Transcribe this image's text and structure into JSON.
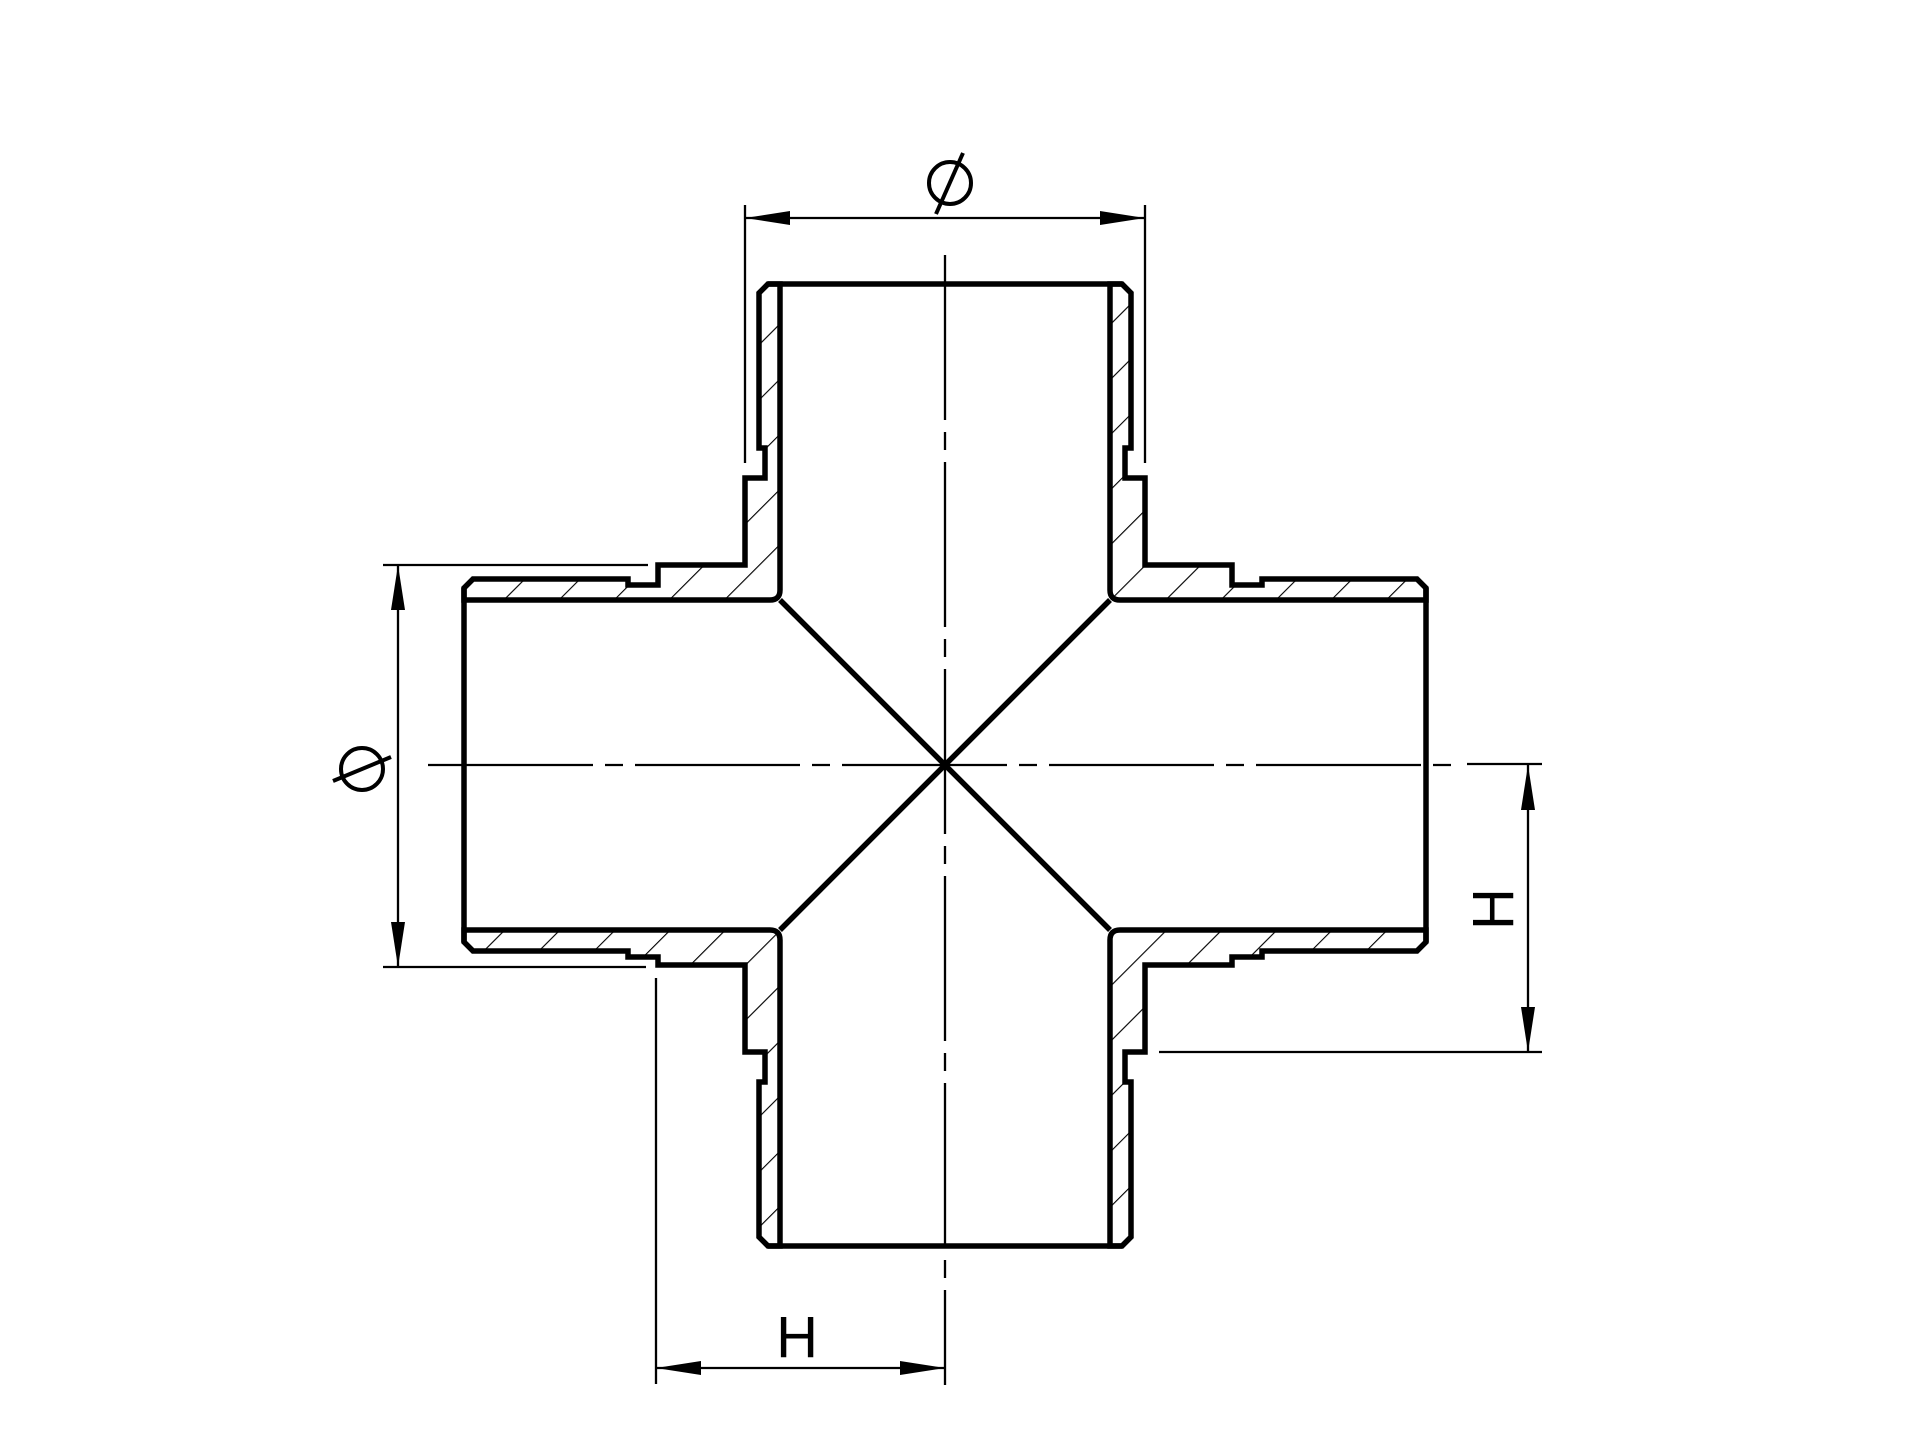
{
  "page": {
    "background": "#ffffff"
  },
  "drawing": {
    "ink_color": "#000000",
    "view": "sectional view of four-way cross pipe fitting"
  },
  "labels": {
    "diameter_top": "Ø",
    "diameter_left": "Ø",
    "h_right": "H",
    "h_bottom": "H"
  }
}
